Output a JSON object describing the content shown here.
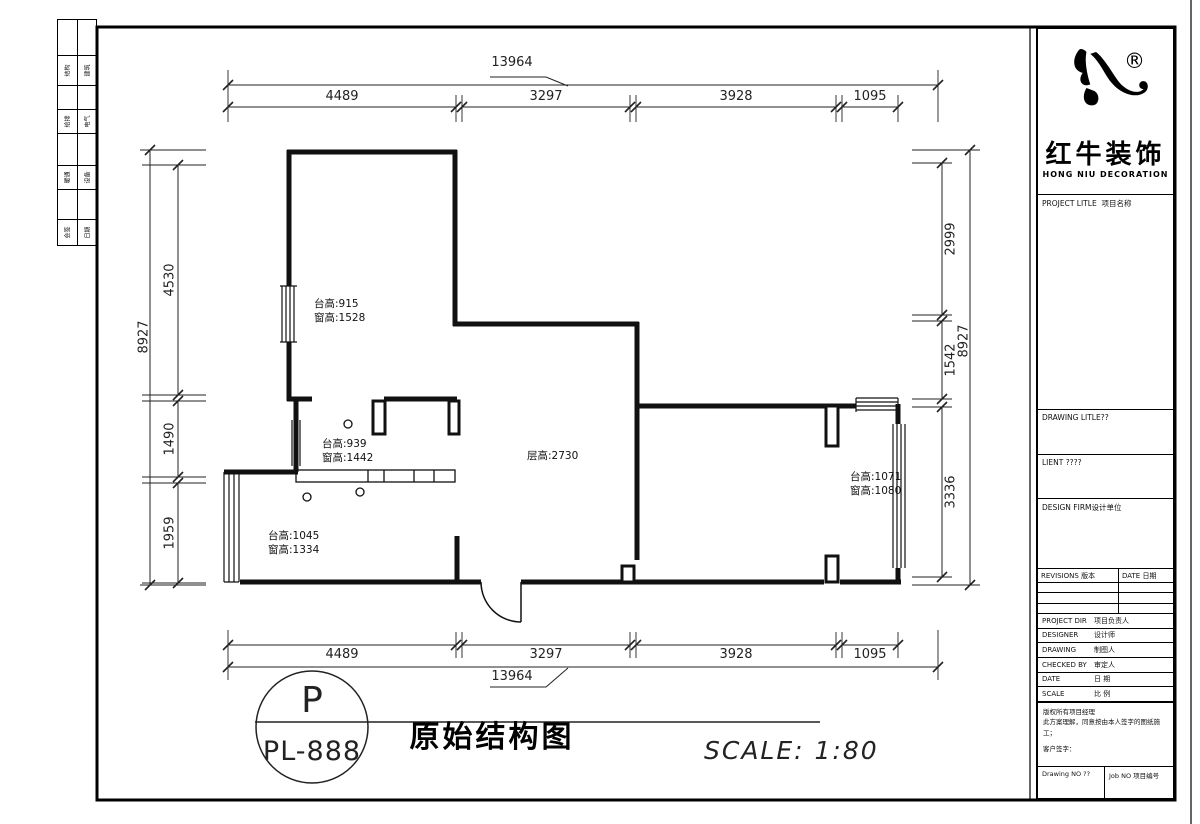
{
  "side_strip": {
    "rows": [
      {
        "c1": "结构",
        "c2": "建筑"
      },
      {
        "c1": "给排",
        "c2": "电气"
      },
      {
        "c1": "暖通",
        "c2": "设备"
      },
      {
        "c1": "会签",
        "c2": "日期"
      }
    ]
  },
  "plan": {
    "annotations": [
      {
        "lines": [
          "台高:915",
          "窗高:1528"
        ]
      },
      {
        "lines": [
          "台高:939",
          "窗高:1442"
        ]
      },
      {
        "lines": [
          "台高:1045",
          "窗高:1334"
        ]
      },
      {
        "lines": [
          "台高:1071",
          "窗高:1080"
        ]
      },
      {
        "lines": [
          "层高:2730"
        ]
      }
    ],
    "dimensions": {
      "top": {
        "overall": "13964",
        "segments": [
          "4489",
          "3297",
          "3928",
          "1095"
        ]
      },
      "bottom": {
        "overall": "13964",
        "segments": [
          "4489",
          "3297",
          "3928",
          "1095"
        ]
      },
      "left": {
        "overall": "8927",
        "segments": [
          "4530",
          "1490",
          "1959"
        ]
      },
      "right": {
        "overall": "8927",
        "segments": [
          "2999",
          "1542",
          "3336"
        ]
      }
    }
  },
  "stamp": {
    "letter": "P",
    "code": "PL-888"
  },
  "footer": {
    "drawing_title": "原始结构图",
    "scale_label": "SCALE: 1:80"
  },
  "brand": {
    "name": "红牛装饰",
    "sub": "HONG NIU DECORATION",
    "registered": "®"
  },
  "title_block": {
    "project_label": {
      "en": "PROJECT LITLE",
      "cn": "项目名称"
    },
    "drawing_label": {
      "en": "DRAWING LITLE??",
      "cn": ""
    },
    "client_label": {
      "en": "LIENT ????",
      "cn": ""
    },
    "firm_label": {
      "en": "DESIGN FIRM",
      "cn": "设计单位"
    },
    "revisions": {
      "rev_en": "REVISIONS",
      "rev_cn": "版本",
      "date_en": "DATE",
      "date_cn": "日期"
    },
    "staff": [
      {
        "en": "PROJECT DIR",
        "cn": "项目负责人"
      },
      {
        "en": "DESIGNER",
        "cn": "设计师"
      },
      {
        "en": "DRAWING",
        "cn": "制图人"
      },
      {
        "en": "CHECKED BY",
        "cn": "审定人"
      },
      {
        "en": "DATE",
        "cn": "日 期"
      },
      {
        "en": "SCALE",
        "cn": "比 例"
      }
    ],
    "notes": [
      "版权所有项目经理",
      "此方案理解，同意按由本人签字的图纸施工；",
      "客户签字："
    ],
    "footer_row": {
      "left": "Drawing NO ??",
      "right": "Job NO 项目编号"
    }
  }
}
